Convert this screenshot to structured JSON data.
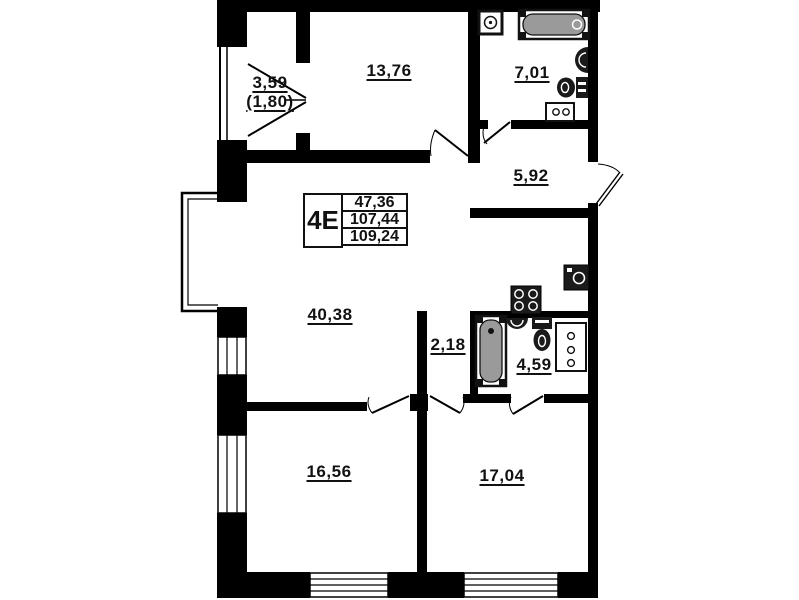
{
  "title": "apartment-floor-plan",
  "unit_box": {
    "unit": "4E",
    "values": [
      "47,36",
      "107,44",
      "109,24"
    ]
  },
  "rooms": [
    {
      "name": "balcony",
      "area": "3,59",
      "area_reduced": "(1,80)"
    },
    {
      "name": "room-13-76",
      "area": "13,76"
    },
    {
      "name": "bathroom-7-01",
      "area": "7,01"
    },
    {
      "name": "hallway-5-92",
      "area": "5,92"
    },
    {
      "name": "living-kitchen-40-38",
      "area": "40,38"
    },
    {
      "name": "corridor-2-18",
      "area": "2,18"
    },
    {
      "name": "bathroom-4-59",
      "area": "4,59"
    },
    {
      "name": "room-16-56",
      "area": "16,56"
    },
    {
      "name": "room-17-04",
      "area": "17,04"
    }
  ],
  "icons": {
    "fixtures": [
      "corner-sink-icon",
      "bathtub-icon",
      "washbasin-icon",
      "toilet-icon",
      "washing-machine-icon",
      "stove-icon",
      "cabinet-icon",
      "door-icon",
      "window-icon"
    ]
  },
  "colors": {
    "wall": "#000000",
    "fixture_dark": "#1a1a1a",
    "bathtub_fill": "#9a9a9a",
    "background": "#ffffff"
  }
}
